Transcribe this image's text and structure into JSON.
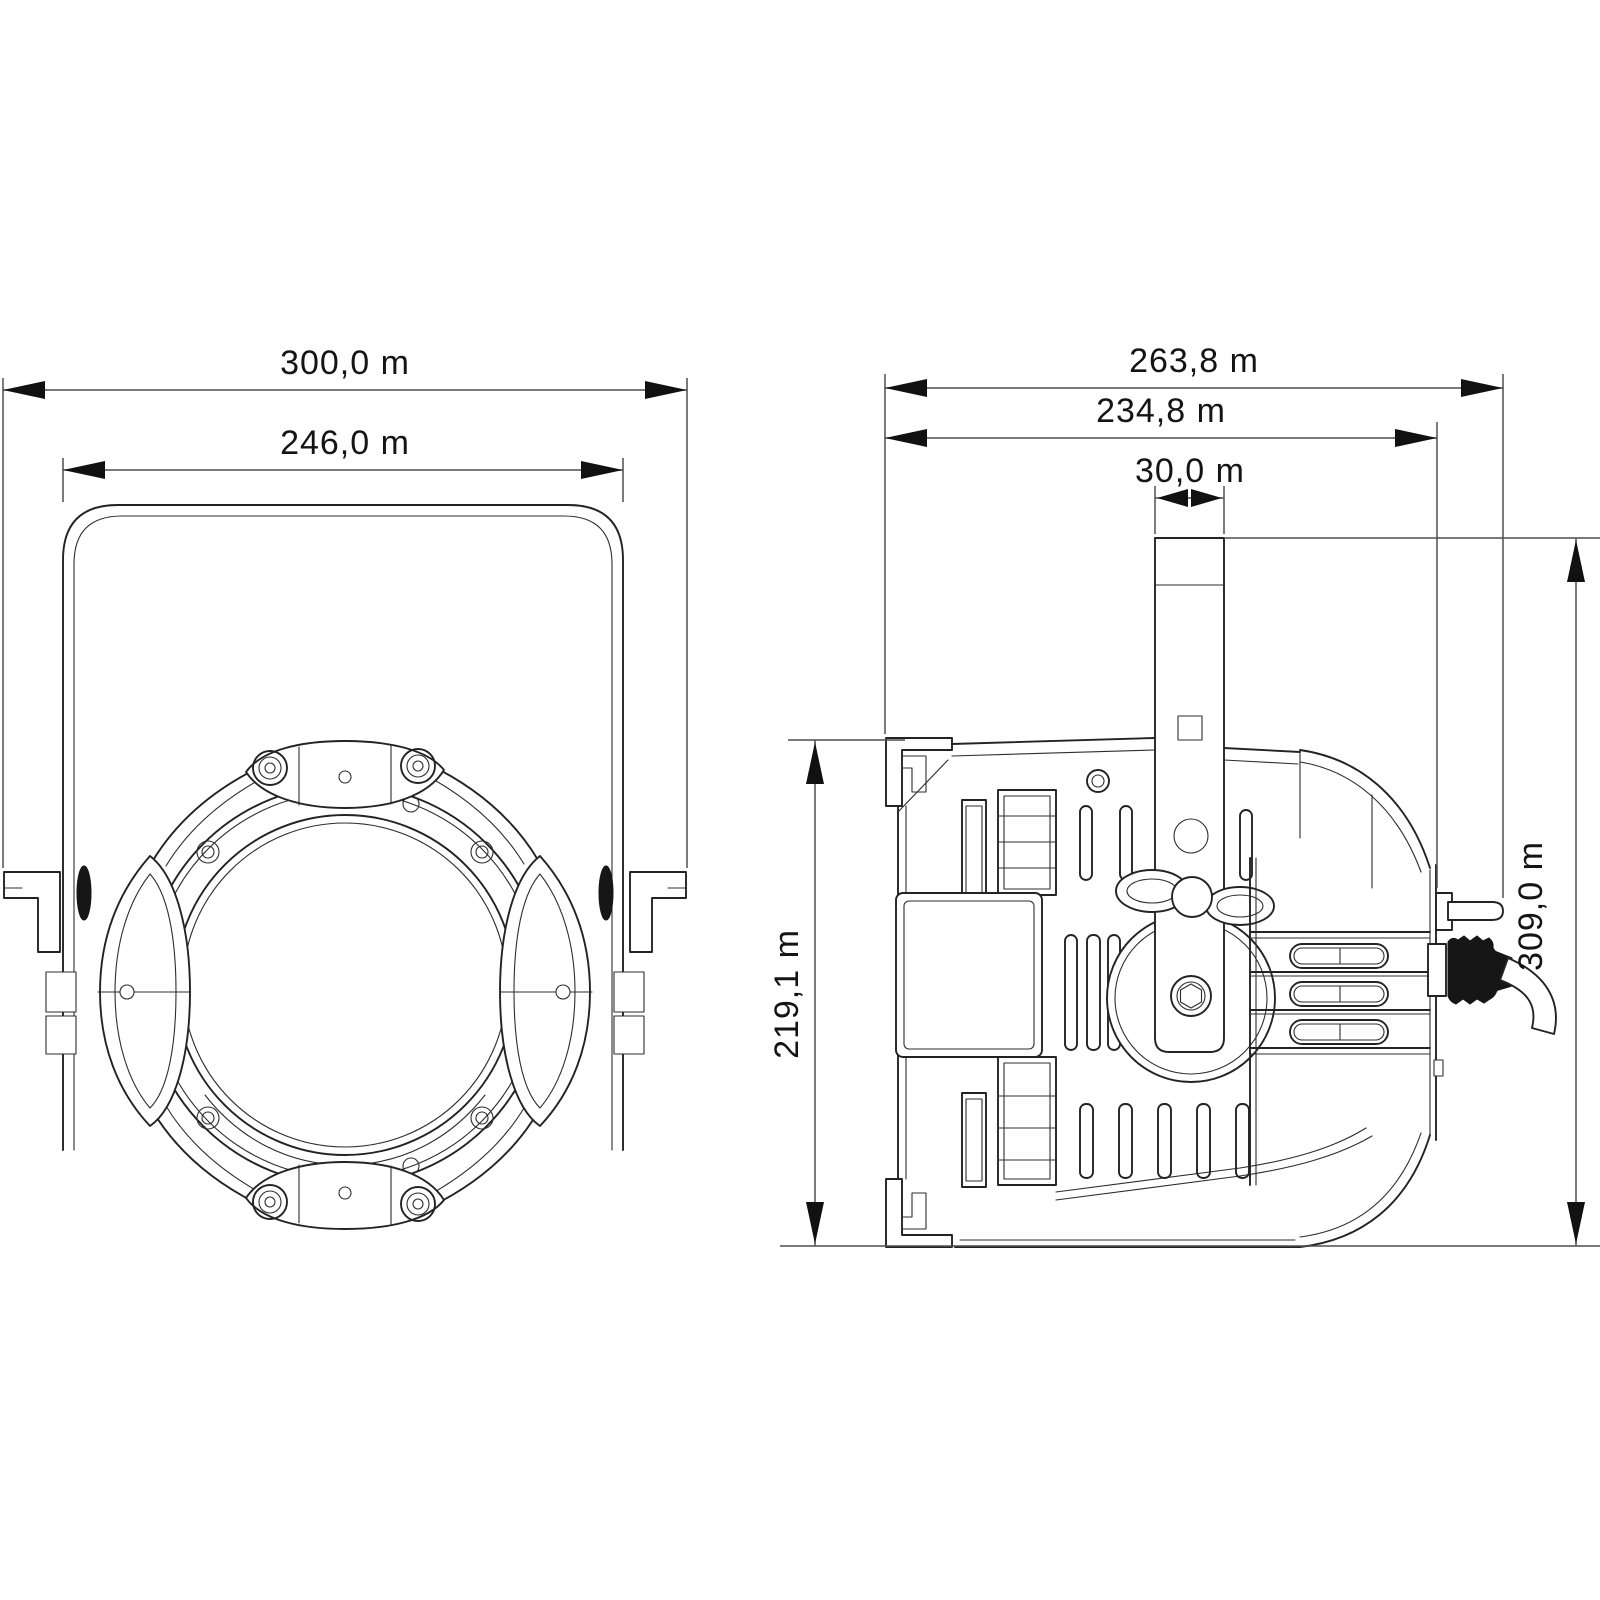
{
  "colors": {
    "background": "#ffffff",
    "drawing_line": "#232323",
    "dimension_line": "#4f4f4f",
    "text": "#141414"
  },
  "views": {
    "front": {
      "dimensions": {
        "overall_width": "300,0 m",
        "yoke_width": "246,0 m"
      }
    },
    "side": {
      "dimensions": {
        "overall_depth": "263,8 m",
        "body_depth": "234,8 m",
        "yoke_bar_width": "30,0 m",
        "body_height": "219,1 m",
        "overall_height": "309,0 m"
      }
    }
  }
}
